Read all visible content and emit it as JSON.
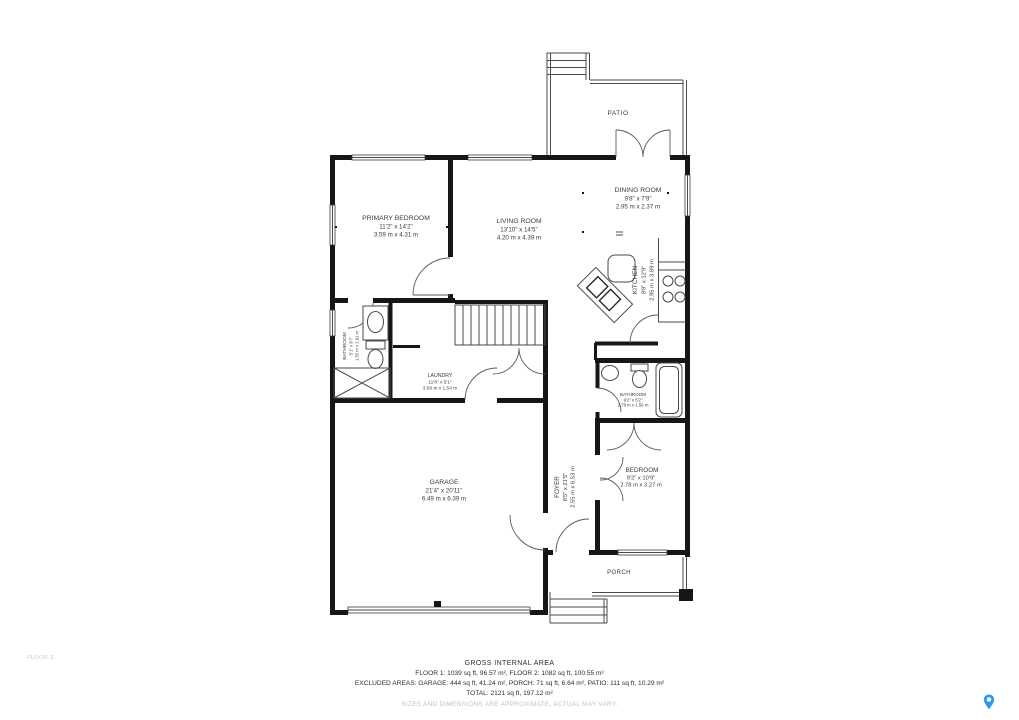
{
  "plan": {
    "floor_label": "FLOOR 2",
    "rooms": {
      "patio": {
        "name": "PATIO"
      },
      "dining_room": {
        "name": "DINING ROOM",
        "imperial": "9'8\" x 7'9\"",
        "metric": "2.95 m x 2.37 m"
      },
      "primary_bedroom": {
        "name": "PRIMARY BEDROOM",
        "imperial": "11'2\" x 14'2\"",
        "metric": "3.59 m x 4.31 m"
      },
      "living_room": {
        "name": "LIVING ROOM",
        "imperial": "13'10\" x 14'5\"",
        "metric": "4.20 m x 4.39 m"
      },
      "kitchen": {
        "name": "KITCHEN",
        "imperial": "9'8\" x 12'9\"",
        "metric": "2.95 m x 3.89 m"
      },
      "bathroom_main": {
        "name": "BATHROOM",
        "imperial": "5'1\" x 9'7\"",
        "metric": "1.55 m x 2.91 m"
      },
      "laundry": {
        "name": "LAUNDRY",
        "imperial": "11'8\" x 5'1\"",
        "metric": "3.56 m x 1.54 m"
      },
      "bathroom_second": {
        "name": "BATHROOM",
        "imperial": "9'2\" x 5'2\"",
        "metric": "2.78 m x 1.56 m"
      },
      "garage": {
        "name": "GARAGE",
        "imperial": "21'4\" x 20'11\"",
        "metric": "6.49 m x 6.39 m"
      },
      "foyer": {
        "name": "FOYER",
        "imperial": "8'5\" x 21'5\"",
        "metric": "2.55 m x 6.53 m"
      },
      "bedroom": {
        "name": "BEDROOM",
        "imperial": "9'2\" x 10'9\"",
        "metric": "2.78 m x 3.27 m"
      },
      "porch": {
        "name": "PORCH"
      }
    },
    "colors": {
      "wall": "#161616",
      "line": "#4a4a4a",
      "label": "#3c3c3c",
      "muted": "#c2c2c2"
    }
  },
  "footer": {
    "title": "GROSS INTERNAL AREA",
    "floors": "FLOOR 1: 1039 sq ft, 96.57 m², FLOOR 2: 1082 sq ft, 100.55 m²",
    "excluded": "EXCLUDED AREAS: GARAGE: 444 sq ft, 41.24 m², PORCH: 71 sq ft, 6.64 m², PATIO: 111 sq ft, 10.29 m²",
    "total": "TOTAL: 2121 sq ft, 197.12 m²",
    "disclaimer": "SIZES AND DIMENSIONS ARE APPROXIMATE, ACTUAL MAY VARY."
  },
  "branding": {
    "pin_color": "#2f9bf0"
  }
}
